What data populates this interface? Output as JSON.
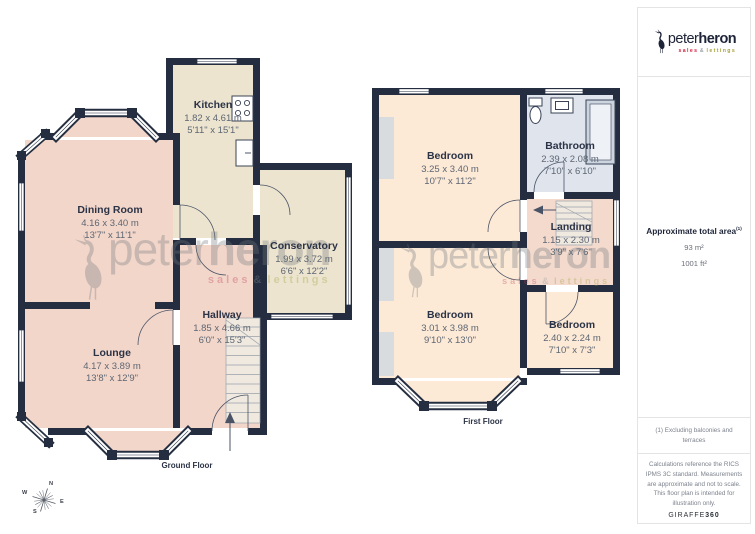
{
  "brand": {
    "name_light": "peter",
    "name_bold": "heron",
    "tagline_sales": "sales",
    "tagline_amp": "&",
    "tagline_lettings": "lettings"
  },
  "floors": [
    {
      "label": "Ground Floor",
      "rooms": [
        {
          "name": "Kitchen",
          "metric": "1.82 x 4.61 m",
          "imperial": "5'11\" x 15'1\""
        },
        {
          "name": "Dining Room",
          "metric": "4.16 x 3.40 m",
          "imperial": "13'7\" x 11'1\""
        },
        {
          "name": "Conservatory",
          "metric": "1.99 x 3.72 m",
          "imperial": "6'6\" x 12'2\""
        },
        {
          "name": "Hallway",
          "metric": "1.85 x 4.66 m",
          "imperial": "6'0\" x 15'3\""
        },
        {
          "name": "Lounge",
          "metric": "4.17 x 3.89 m",
          "imperial": "13'8\" x 12'9\""
        }
      ]
    },
    {
      "label": "First Floor",
      "rooms": [
        {
          "name": "Bedroom",
          "metric": "3.25 x 3.40 m",
          "imperial": "10'7\" x 11'2\""
        },
        {
          "name": "Bathroom",
          "metric": "2.39 x 2.08 m",
          "imperial": "7'10\" x 6'10\""
        },
        {
          "name": "Landing",
          "metric": "1.15 x 2.30 m",
          "imperial": "3'9\" x 7'6\""
        },
        {
          "name": "Bedroom",
          "metric": "3.01 x 3.98 m",
          "imperial": "9'10\" x 13'0\""
        },
        {
          "name": "Bedroom",
          "metric": "2.40 x 2.24 m",
          "imperial": "7'10\" x 7'3\""
        }
      ]
    }
  ],
  "compass": {
    "n": "N",
    "e": "E",
    "s": "S",
    "w": "W"
  },
  "sidebar": {
    "area_title": "Approximate total area",
    "area_superscript": "(1)",
    "area_m2": "93 m²",
    "area_ft2": "1001 ft²",
    "footnote": "(1) Excluding balconies and terraces",
    "disclaimer": "Calculations reference the RICS IPMS 3C standard. Measurements are approximate and not to scale. This floor plan is intended for illustration only.",
    "credit_normal": "GIRAFFE",
    "credit_bold": "360"
  },
  "colors": {
    "wall": "#242e40",
    "room_pink": "#f3d6ca",
    "room_beige": "#ece4cf",
    "room_peach": "#fce9d6",
    "bathroom_blue": "#dfe4ed",
    "landing_pink": "#f3dacd",
    "brand_red": "#d6203c",
    "brand_olive": "#a8a23a",
    "brand_navy": "#1e2438"
  }
}
